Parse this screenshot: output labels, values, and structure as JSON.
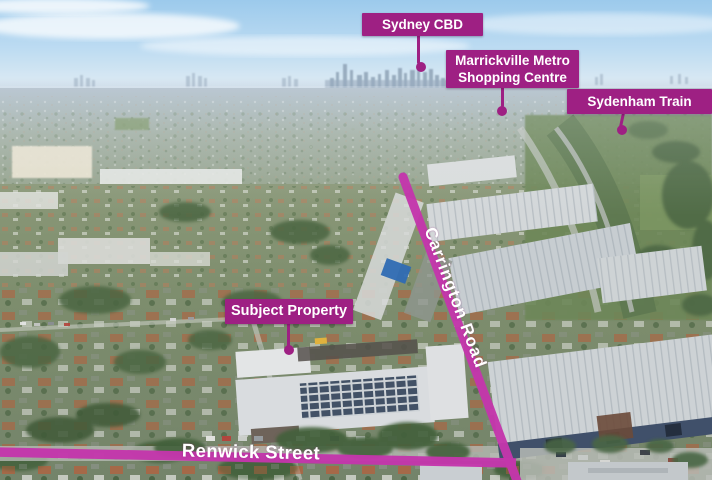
{
  "colors": {
    "label_bg": "#9E2083",
    "label_text": "#FFFFFF",
    "road_line": "#C436AC"
  },
  "callouts": {
    "sydney_cbd": "Sydney CBD",
    "marrickville_metro": "Marrickville Metro Shopping Centre",
    "sydenham_train": "Sydenham Train",
    "subject_property": "Subject Property"
  },
  "street_labels": {
    "carrington_road": "Carrington Road",
    "renwick_street": "Renwick Street"
  }
}
